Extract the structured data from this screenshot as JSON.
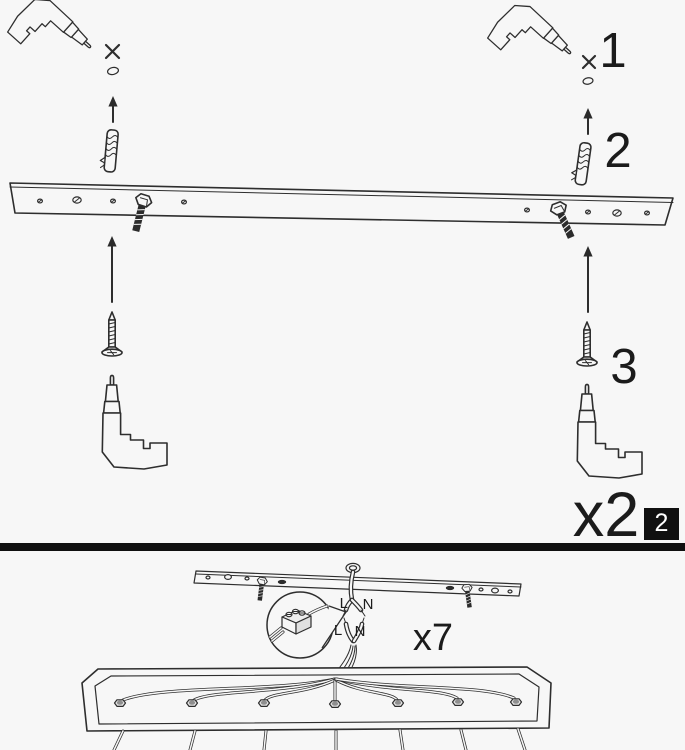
{
  "colors": {
    "background": "#f7f7f7",
    "ink": "#2e2e2e",
    "divider_black": "#101010",
    "badge_background": "#101010",
    "badge_text": "#ffffff"
  },
  "top_panel": {
    "step_1": "1",
    "step_2": "2",
    "step_3": "3",
    "quantity": "x2",
    "page_badge": "2"
  },
  "bottom_panel": {
    "upper_terminal": {
      "live": "L",
      "neutral": "N"
    },
    "lower_terminal": {
      "live": "L",
      "neutral": "N"
    },
    "quantity": "x7"
  }
}
